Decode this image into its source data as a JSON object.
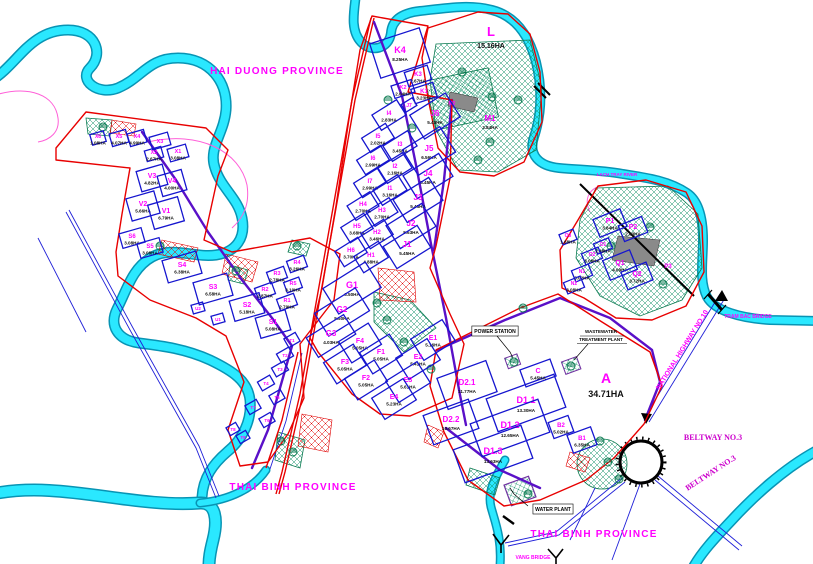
{
  "colors": {
    "label_magenta": "#ff00ff",
    "area_text_black": "#101010",
    "parcel_border_blue": "#1515cf",
    "boundary_red": "#e80000",
    "road_purple": "#5a10c8",
    "river_cyan": "#2ae8ff",
    "hatch_green": "#0e8f66",
    "hatch_red": "#e00000",
    "grid_purple": "#8040c0"
  },
  "map": {
    "provinces": [
      {
        "id": "hai-duong",
        "label": "HAI DUONG PROVINCE",
        "x": 277,
        "y": 74
      },
      {
        "id": "thai-binh-west",
        "label": "THAI BINH PROVINCE",
        "x": 293,
        "y": 490
      },
      {
        "id": "thai-binh-south",
        "label": "THAI BINH PROVINCE",
        "x": 594,
        "y": 537
      }
    ],
    "landmarks": [
      {
        "id": "lach-tray-river",
        "label": "LACH TRAY RIVER",
        "x": 617,
        "y": 176,
        "rot": 0,
        "fs": 4.5,
        "color": "#ff00ff"
      },
      {
        "id": "tram-bac-bridge",
        "label": "TRAM BAC BRIDGE",
        "x": 748,
        "y": 318,
        "rot": 0,
        "fs": 5,
        "color": "#ff00ff"
      },
      {
        "id": "vang-bridge",
        "label": "VANG BRIDGE",
        "x": 533,
        "y": 559,
        "rot": 0,
        "fs": 5,
        "color": "#ff00ff"
      },
      {
        "id": "national-highway-10",
        "label": "NATIONAL HIGHWAY NO.10",
        "x": 684,
        "y": 351,
        "rot": -58,
        "fs": 7,
        "color": "#ff00ff"
      },
      {
        "id": "beltway-3-east",
        "label": "BELTWAY NO.3",
        "x": 713,
        "y": 440,
        "rot": 0,
        "fs": 8,
        "color": "#cc00cc",
        "serif": true
      },
      {
        "id": "beltway-3-south",
        "label": "BELTWAY NO.3",
        "x": 712,
        "y": 475,
        "rot": -33,
        "fs": 8,
        "color": "#cc00cc",
        "serif": true
      },
      {
        "id": "water-plant",
        "label": "WATER PLANT",
        "x": 553,
        "y": 511,
        "rot": 0,
        "fs": 5,
        "color": "#000000",
        "box": true
      },
      {
        "id": "power-station",
        "label": "POWER STATION",
        "x": 495,
        "y": 333,
        "rot": 0,
        "fs": 5,
        "color": "#000000",
        "box": true
      },
      {
        "id": "wastewater-1",
        "label": "WASTEWATER",
        "x": 601,
        "y": 333,
        "rot": 0,
        "fs": 4.5,
        "color": "#000000"
      },
      {
        "id": "wastewater-2",
        "label": "TREATMENT PLANT",
        "x": 601,
        "y": 341,
        "rot": 0,
        "fs": 4.5,
        "color": "#000000"
      }
    ],
    "parcels": [
      {
        "id": "L",
        "a": "15.16HA",
        "x": 491,
        "y": 36,
        "fs": 13,
        "ay": 12,
        "af": 7
      },
      {
        "id": "K4",
        "a": "8.25HA",
        "x": 400,
        "y": 53,
        "w": 52,
        "h": 36,
        "r": -18,
        "fs": 9,
        "ay": 8
      },
      {
        "id": "K3",
        "a": "2.67HA",
        "x": 418,
        "y": 76,
        "w": 24,
        "h": 15,
        "r": -18,
        "fs": 6
      },
      {
        "id": "K2",
        "a": "2.04HA",
        "x": 403,
        "y": 89,
        "w": 21,
        "h": 13,
        "r": -18,
        "fs": 5.5
      },
      {
        "id": "K1",
        "a": "3.23HA",
        "x": 424,
        "y": 93,
        "w": 23,
        "h": 15,
        "r": -18,
        "fs": 6
      },
      {
        "id": "M2",
        "x": 452,
        "y": 103,
        "fs": 5
      },
      {
        "id": "M1",
        "a": "3.84HA",
        "x": 490,
        "y": 121,
        "fs": 8,
        "ay": 8
      },
      {
        "id": "J7",
        "x": 409,
        "y": 105,
        "w": 13,
        "h": 9,
        "r": -32,
        "fs": 5
      },
      {
        "id": "I4",
        "a": "2.83HA",
        "x": 389,
        "y": 115,
        "w": 29,
        "h": 18,
        "r": -32,
        "fs": 6
      },
      {
        "id": "J6",
        "a": "5.43HA",
        "x": 435,
        "y": 116,
        "w": 42,
        "h": 28,
        "r": -32,
        "fs": 8,
        "ay": 8
      },
      {
        "id": "I5",
        "a": "2.02HA",
        "x": 378,
        "y": 138,
        "w": 28,
        "h": 17,
        "r": -32,
        "fs": 6
      },
      {
        "id": "I3",
        "a": "3.45HA",
        "x": 400,
        "y": 146,
        "w": 29,
        "h": 18,
        "r": -32,
        "fs": 6
      },
      {
        "id": "J5",
        "a": "6.56HA",
        "x": 429,
        "y": 151,
        "w": 44,
        "h": 30,
        "r": -32,
        "fs": 8,
        "ay": 8
      },
      {
        "id": "I6",
        "a": "2.99HA",
        "x": 373,
        "y": 160,
        "w": 28,
        "h": 17,
        "r": -32,
        "fs": 6
      },
      {
        "id": "I2",
        "a": "2.16HA",
        "x": 395,
        "y": 168,
        "w": 29,
        "h": 18,
        "r": -32,
        "fs": 6
      },
      {
        "id": "J4",
        "a": "5.45HA",
        "x": 428,
        "y": 176,
        "w": 42,
        "h": 27,
        "r": -32,
        "fs": 8,
        "ay": 8
      },
      {
        "id": "I7",
        "a": "2.99HA",
        "x": 370,
        "y": 183,
        "w": 28,
        "h": 17,
        "r": -32,
        "fs": 6
      },
      {
        "id": "I1",
        "a": "3.16HA",
        "x": 390,
        "y": 190,
        "w": 29,
        "h": 18,
        "r": -32,
        "fs": 6
      },
      {
        "id": "J3",
        "a": "5.45HA",
        "x": 418,
        "y": 200,
        "w": 42,
        "h": 27,
        "r": -32,
        "fs": 8,
        "ay": 8
      },
      {
        "id": "H4",
        "a": "2.70HA",
        "x": 363,
        "y": 206,
        "w": 27,
        "h": 17,
        "r": -32,
        "fs": 6
      },
      {
        "id": "H3",
        "a": "2.70HA",
        "x": 382,
        "y": 212,
        "w": 27,
        "h": 17,
        "r": -32,
        "fs": 6
      },
      {
        "id": "J2",
        "a": "5.63HA",
        "x": 411,
        "y": 226,
        "w": 42,
        "h": 27,
        "r": -32,
        "fs": 8,
        "ay": 8
      },
      {
        "id": "H5",
        "a": "3.68HA",
        "x": 357,
        "y": 228,
        "w": 27,
        "h": 18,
        "r": -32,
        "fs": 6
      },
      {
        "id": "H2",
        "a": "3.46HA",
        "x": 377,
        "y": 234,
        "w": 27,
        "h": 18,
        "r": -32,
        "fs": 6
      },
      {
        "id": "J1",
        "a": "5.45HA",
        "x": 407,
        "y": 247,
        "w": 40,
        "h": 26,
        "r": -32,
        "fs": 8,
        "ay": 8
      },
      {
        "id": "H6",
        "a": "3.70HA",
        "x": 351,
        "y": 252,
        "w": 27,
        "h": 18,
        "r": -32,
        "fs": 6
      },
      {
        "id": "H1",
        "a": "4.88HA",
        "x": 371,
        "y": 257,
        "w": 29,
        "h": 19,
        "r": -32,
        "fs": 6
      },
      {
        "id": "G1",
        "a": "6.50HA",
        "x": 352,
        "y": 288,
        "w": 50,
        "h": 30,
        "r": -32,
        "fs": 9,
        "ay": 8
      },
      {
        "id": "G2",
        "a": "5.50HA",
        "x": 342,
        "y": 312,
        "w": 48,
        "h": 27,
        "r": -32,
        "fs": 8,
        "ay": 8
      },
      {
        "id": "G3",
        "a": "4.03HA",
        "x": 331,
        "y": 336,
        "w": 44,
        "h": 23,
        "r": -32,
        "fs": 8,
        "ay": 8
      },
      {
        "id": "F4",
        "a": "5.05HA",
        "x": 360,
        "y": 343,
        "w": 35,
        "h": 25,
        "r": -32,
        "fs": 7
      },
      {
        "id": "F1",
        "a": "5.05HA",
        "x": 381,
        "y": 354,
        "w": 35,
        "h": 25,
        "r": -32,
        "fs": 7
      },
      {
        "id": "F3",
        "a": "5.05HA",
        "x": 345,
        "y": 364,
        "w": 35,
        "h": 25,
        "r": -32,
        "fs": 7
      },
      {
        "id": "F2",
        "a": "5.05HA",
        "x": 366,
        "y": 380,
        "w": 35,
        "h": 25,
        "r": -32,
        "fs": 7
      },
      {
        "id": "E1",
        "a": "5.16HA",
        "x": 433,
        "y": 340,
        "w": 37,
        "h": 25,
        "r": -32,
        "fs": 7
      },
      {
        "id": "E2",
        "a": "5.41HA",
        "x": 418,
        "y": 359,
        "w": 37,
        "h": 25,
        "r": -32,
        "fs": 7
      },
      {
        "id": "E3",
        "a": "5.61HA",
        "x": 408,
        "y": 382,
        "w": 37,
        "h": 25,
        "r": -32,
        "fs": 7
      },
      {
        "id": "E4",
        "a": "5.23HA",
        "x": 394,
        "y": 399,
        "w": 37,
        "h": 25,
        "r": -32,
        "fs": 7
      },
      {
        "id": "D2.1",
        "a": "11.77HA",
        "x": 467,
        "y": 385,
        "w": 52,
        "h": 33,
        "fs": 8,
        "ay": 8
      },
      {
        "id": "D2.2",
        "a": "10.67HA",
        "x": 451,
        "y": 422,
        "w": 48,
        "h": 31,
        "fs": 8,
        "ay": 8
      },
      {
        "id": "D1.1",
        "a": "13.30HA",
        "x": 526,
        "y": 403,
        "w": 72,
        "h": 35,
        "fs": 9,
        "ay": 9
      },
      {
        "id": "D1.2",
        "a": "12.65HA",
        "x": 510,
        "y": 428,
        "w": 72,
        "h": 35,
        "fs": 9,
        "ay": 9
      },
      {
        "id": "D1.3",
        "a": "13.63HA",
        "x": 493,
        "y": 454,
        "w": 72,
        "h": 35,
        "fs": 9,
        "ay": 9
      },
      {
        "id": "C",
        "a": "5.45HA",
        "x": 538,
        "y": 373,
        "w": 32,
        "h": 18,
        "fs": 7
      },
      {
        "id": "B2",
        "a": "5.02HA",
        "x": 561,
        "y": 427,
        "w": 21,
        "h": 17,
        "fs": 6
      },
      {
        "id": "B1",
        "a": "6.35HA",
        "x": 582,
        "y": 440,
        "w": 25,
        "h": 19,
        "fs": 6
      },
      {
        "id": "A",
        "a": "34.71HA",
        "x": 606,
        "y": 383,
        "fs": 14,
        "ay": 14,
        "af": 9
      },
      {
        "id": "P1",
        "a": "3.84HA",
        "x": 610,
        "y": 223,
        "w": 29,
        "h": 19,
        "r": -22,
        "fs": 7
      },
      {
        "id": "P2",
        "a": "2.83HA",
        "x": 633,
        "y": 229,
        "w": 25,
        "h": 17,
        "r": -22,
        "fs": 7
      },
      {
        "id": "P3",
        "x": 668,
        "y": 266,
        "fs": 6
      },
      {
        "id": "O3",
        "a": "1.68HA",
        "x": 568,
        "y": 237,
        "w": 15,
        "h": 11,
        "r": -22,
        "fs": 5
      },
      {
        "id": "O1",
        "a": "2.48HA",
        "x": 603,
        "y": 246,
        "w": 16,
        "h": 11,
        "r": -22,
        "fs": 5
      },
      {
        "id": "O2",
        "a": "3.08HA",
        "x": 592,
        "y": 256,
        "w": 18,
        "h": 12,
        "r": -22,
        "fs": 5
      },
      {
        "id": "N1",
        "a": "3.02HA",
        "x": 582,
        "y": 273,
        "w": 18,
        "h": 12,
        "r": -22,
        "fs": 5
      },
      {
        "id": "N2",
        "a": "3.08HA",
        "x": 574,
        "y": 285,
        "w": 18,
        "h": 12,
        "r": -22,
        "fs": 5
      },
      {
        "id": "Q1",
        "a": "4.09HA",
        "x": 620,
        "y": 265,
        "w": 29,
        "h": 21,
        "r": -22,
        "fs": 7
      },
      {
        "id": "Q2",
        "a": "3.72HA",
        "x": 637,
        "y": 276,
        "w": 27,
        "h": 19,
        "r": -22,
        "fs": 7
      },
      {
        "id": "X6",
        "a": "1.08HA",
        "x": 98,
        "y": 138,
        "w": 14,
        "h": 11,
        "r": -16,
        "fs": 5
      },
      {
        "id": "X5",
        "a": "4.07HA",
        "x": 119,
        "y": 138,
        "w": 17,
        "h": 13,
        "r": -16,
        "fs": 5.5
      },
      {
        "id": "X4",
        "a": "4.99HA",
        "x": 137,
        "y": 138,
        "w": 17,
        "h": 13,
        "r": -16,
        "fs": 5.5
      },
      {
        "id": "X3",
        "x": 160,
        "y": 141,
        "w": 19,
        "h": 13,
        "r": -16,
        "fs": 5.5
      },
      {
        "id": "X2",
        "a": "2.67HA",
        "x": 154,
        "y": 154,
        "w": 17,
        "h": 11,
        "r": -16,
        "fs": 5.5
      },
      {
        "id": "X1",
        "a": "3.08HA",
        "x": 178,
        "y": 153,
        "w": 19,
        "h": 13,
        "r": -16,
        "fs": 5.5
      },
      {
        "id": "V3",
        "a": "4.82HA",
        "x": 152,
        "y": 178,
        "w": 27,
        "h": 21,
        "r": -16,
        "fs": 7
      },
      {
        "id": "V4",
        "a": "4.00HA",
        "x": 172,
        "y": 183,
        "w": 25,
        "h": 21,
        "r": -16,
        "fs": 7
      },
      {
        "id": "V2",
        "a": "5.66HA",
        "x": 143,
        "y": 206,
        "w": 29,
        "h": 23,
        "r": -16,
        "fs": 7
      },
      {
        "id": "V1",
        "a": "6.79HA",
        "x": 166,
        "y": 213,
        "w": 31,
        "h": 25,
        "r": -16,
        "fs": 7
      },
      {
        "id": "S6",
        "a": "3.08HA",
        "x": 132,
        "y": 238,
        "w": 23,
        "h": 15,
        "r": -16,
        "fs": 6
      },
      {
        "id": "S5",
        "a": "3.08HA",
        "x": 150,
        "y": 248,
        "w": 23,
        "h": 15,
        "r": -16,
        "fs": 6
      },
      {
        "id": "S4",
        "a": "6.38HA",
        "x": 182,
        "y": 267,
        "w": 35,
        "h": 23,
        "r": -16,
        "fs": 7
      },
      {
        "id": "S3",
        "a": "6.58HA",
        "x": 213,
        "y": 289,
        "w": 35,
        "h": 23,
        "r": -16,
        "fs": 7
      },
      {
        "id": "S2",
        "a": "5.18HA",
        "x": 247,
        "y": 307,
        "w": 31,
        "h": 21,
        "r": -16,
        "fs": 7
      },
      {
        "id": "S1",
        "a": "5.08HA",
        "x": 273,
        "y": 324,
        "w": 31,
        "h": 21,
        "r": -16,
        "fs": 7
      },
      {
        "id": "U2",
        "x": 198,
        "y": 308,
        "w": 12,
        "h": 9,
        "r": -16,
        "fs": 4.5
      },
      {
        "id": "U1",
        "x": 218,
        "y": 319,
        "w": 12,
        "h": 9,
        "r": -16,
        "fs": 4.5
      },
      {
        "id": "R4",
        "a": "3.26HA",
        "x": 297,
        "y": 264,
        "w": 18,
        "h": 12,
        "r": -20,
        "fs": 5.5
      },
      {
        "id": "R3",
        "a": "2.78HA",
        "x": 277,
        "y": 275,
        "w": 18,
        "h": 12,
        "r": -20,
        "fs": 5.5
      },
      {
        "id": "R5",
        "a": "3.10HA",
        "x": 293,
        "y": 285,
        "w": 16,
        "h": 11,
        "r": -20,
        "fs": 5.5
      },
      {
        "id": "R2",
        "a": "2.87HA",
        "x": 265,
        "y": 291,
        "w": 18,
        "h": 12,
        "r": -20,
        "fs": 5.5
      },
      {
        "id": "R1",
        "a": "2.79HA",
        "x": 287,
        "y": 302,
        "w": 18,
        "h": 12,
        "r": -20,
        "fs": 5.5
      },
      {
        "id": "T1",
        "x": 292,
        "y": 340,
        "w": 13,
        "h": 10,
        "r": -30,
        "fs": 4.5
      },
      {
        "id": "T2",
        "x": 285,
        "y": 355,
        "w": 14,
        "h": 10,
        "r": -30,
        "fs": 4.5
      },
      {
        "id": "T3",
        "x": 280,
        "y": 369,
        "w": 14,
        "h": 10,
        "r": -30,
        "fs": 4.5
      },
      {
        "id": "T4",
        "x": 266,
        "y": 383,
        "w": 14,
        "h": 10,
        "r": -30,
        "fs": 4.5
      },
      {
        "id": "T5",
        "x": 277,
        "y": 397,
        "w": 13,
        "h": 10,
        "r": -30,
        "fs": 4.5
      },
      {
        "id": "T7",
        "x": 253,
        "y": 407,
        "w": 13,
        "h": 10,
        "r": -30,
        "fs": 4.5
      },
      {
        "id": "T6",
        "x": 267,
        "y": 420,
        "w": 13,
        "h": 10,
        "r": -30,
        "fs": 4.5
      },
      {
        "id": "T8",
        "x": 233,
        "y": 429,
        "w": 11,
        "h": 9,
        "r": -30,
        "fs": 4.5
      },
      {
        "id": "T9",
        "x": 243,
        "y": 437,
        "w": 11,
        "h": 9,
        "r": -30,
        "fs": 4.5
      }
    ],
    "trees": [
      [
        103,
        127
      ],
      [
        388,
        100
      ],
      [
        412,
        128
      ],
      [
        462,
        72
      ],
      [
        492,
        97
      ],
      [
        518,
        100
      ],
      [
        478,
        160
      ],
      [
        490,
        142
      ],
      [
        236,
        271
      ],
      [
        297,
        246
      ],
      [
        387,
        320
      ],
      [
        404,
        342
      ],
      [
        431,
        369
      ],
      [
        514,
        362
      ],
      [
        571,
        366
      ],
      [
        611,
        246
      ],
      [
        650,
        227
      ],
      [
        663,
        284
      ],
      [
        600,
        441
      ],
      [
        608,
        462
      ],
      [
        619,
        479
      ],
      [
        528,
        494
      ],
      [
        293,
        452
      ],
      [
        281,
        441
      ],
      [
        523,
        308
      ],
      [
        377,
        303
      ],
      [
        160,
        246
      ]
    ]
  }
}
